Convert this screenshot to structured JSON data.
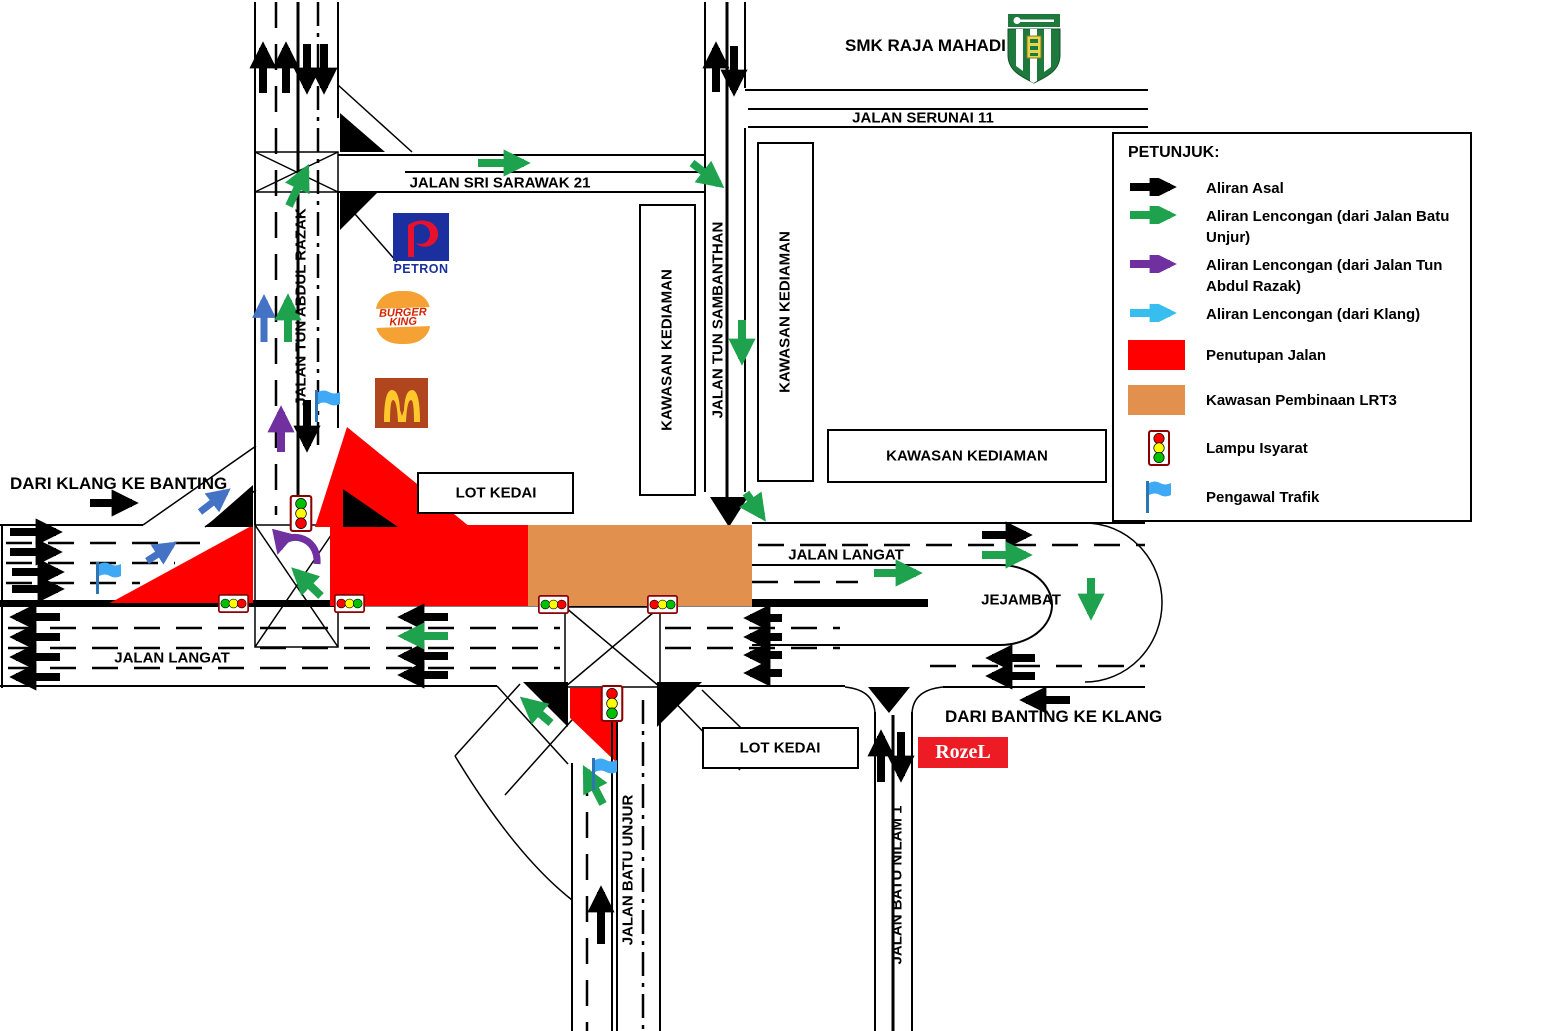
{
  "colors": {
    "closure_red": "#FF0000",
    "construction_orange": "#E2904E",
    "diversion_green": "#1FA24E",
    "diversion_purple": "#7030A0",
    "diversion_blue": "#4472C4",
    "legend_blue": "#38BDEF",
    "flag_blue": "#3FA9F5"
  },
  "titles": {
    "school": "SMK RAJA MAHADI",
    "from_klang": "DARI KLANG KE BANTING",
    "from_banting": "DARI BANTING KE KLANG"
  },
  "roads": {
    "serunai": "JALAN SERUNAI 11",
    "sri_sarawak": "JALAN SRI SARAWAK 21",
    "tun_abdul_razak": "JALAN TUN ABDUL RAZAK",
    "tun_sambanthan": "JALAN TUN SAMBANTHAN",
    "langat": "JALAN LANGAT",
    "batu_unjur": "JALAN BATU UNJUR",
    "batu_nilam": "JALAN BATU NILAM 1",
    "jejambat": "JEJAMBAT"
  },
  "areas": {
    "kawasan_kediaman": "KAWASAN KEDIAMAN",
    "lot_kedai": "LOT KEDAI"
  },
  "logos": {
    "petron": "PETRON",
    "burger_king_top": "BURGER",
    "burger_king_bottom": "KING",
    "rozel": "RozeL"
  },
  "legend": {
    "title": "PETUNJUK:",
    "items": [
      {
        "icon": "black-arrow",
        "label": "Aliran Asal"
      },
      {
        "icon": "green-arrow",
        "label": "Aliran Lencongan (dari Jalan Batu Unjur)"
      },
      {
        "icon": "purple-arrow",
        "label": "Aliran Lencongan (dari Jalan Tun Abdul Razak)"
      },
      {
        "icon": "blue-arrow",
        "label": "Aliran Lencongan (dari Klang)"
      },
      {
        "icon": "red-swatch",
        "label": "Penutupan Jalan"
      },
      {
        "icon": "orange-swatch",
        "label": "Kawasan Pembinaan LRT3"
      },
      {
        "icon": "traffic-light",
        "label": "Lampu Isyarat"
      },
      {
        "icon": "flag",
        "label": "Pengawal Trafik"
      }
    ]
  }
}
